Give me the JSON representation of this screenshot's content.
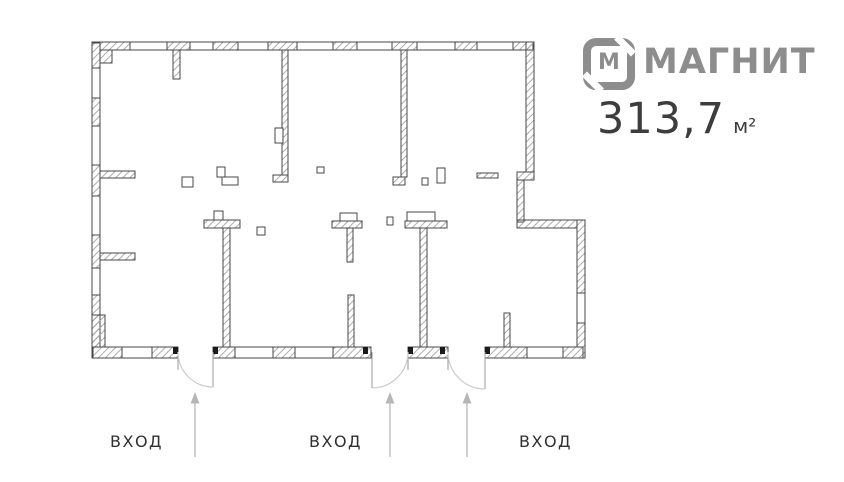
{
  "branding": {
    "logo_monogram": "М",
    "logo_name": "МАГНИТ",
    "area": {
      "value": "313,7",
      "unit": "м²"
    }
  },
  "floorplan": {
    "entrances": [
      {
        "label": "ВХОД"
      },
      {
        "label": "ВХОД"
      },
      {
        "label": "ВХОД"
      }
    ]
  },
  "colors": {
    "logo_gray": "#8d8d8d",
    "area_color": "#3d3d3d",
    "label_color": "#303030",
    "arrow_gray": "#b6b6b6",
    "wall_line": "#474747",
    "door_arc": "#cccccc"
  }
}
